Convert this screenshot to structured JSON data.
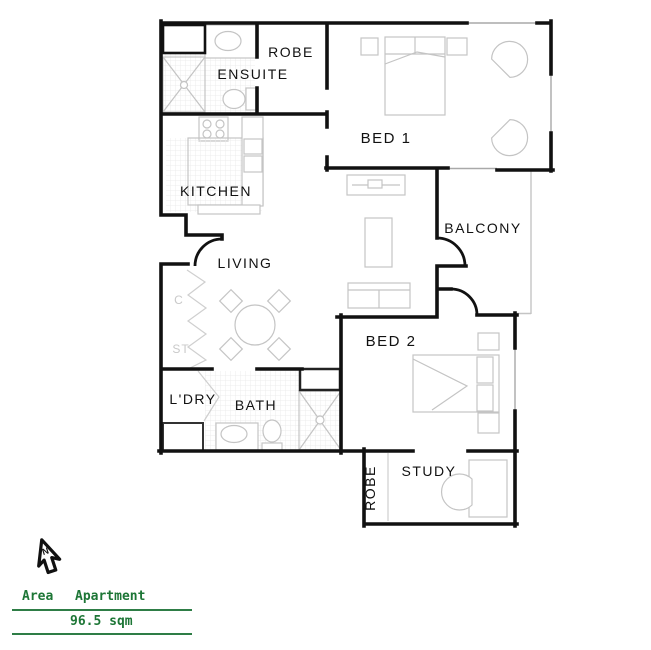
{
  "floorplan": {
    "labels": {
      "robe1": "ROBE",
      "ensuite": "ENSUITE",
      "bed1": "BED 1",
      "kitchen": "KITCHEN",
      "balcony": "BALCONY",
      "living": "LIVING",
      "bed2": "BED 2",
      "ldry": "L'DRY",
      "bath": "BATH",
      "robe2": "ROBE",
      "study": "STUDY",
      "cupboard": "C",
      "store": "ST"
    },
    "colors": {
      "wall": "#111111",
      "furniture": "#c4c4c4",
      "hatch": "#ececec",
      "closet_label": "#c9c9c9"
    }
  },
  "north_arrow": {
    "label": "N"
  },
  "legend": {
    "area_label": "Area",
    "column_label": "Apartment",
    "area_value": "96.5 sqm",
    "color": "#1d7636"
  }
}
